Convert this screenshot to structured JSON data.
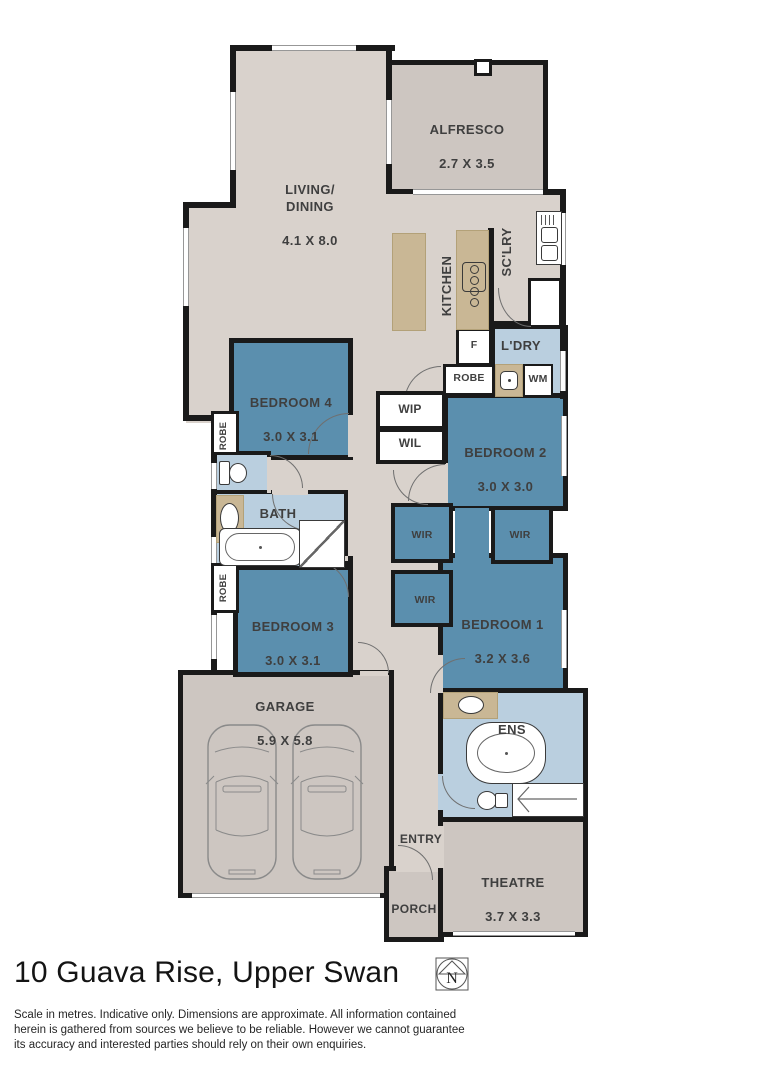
{
  "title": "10 Guava Rise, Upper Swan",
  "compass": {
    "label": "N"
  },
  "disclaimer": "Scale in metres. Indicative only. Dimensions are approximate. All information contained herein is gathered from sources we believe to be reliable. However we cannot guarantee its accuracy and interested parties should rely on their own enquiries.",
  "rooms": {
    "alfresco": {
      "name": "ALFRESCO",
      "dims": "2.7 X 3.5"
    },
    "living": {
      "name": "LIVING/\nDINING",
      "dims": "4.1 X 8.0"
    },
    "kitchen": {
      "name": "KITCHEN"
    },
    "scullery": {
      "name": "SC'LRY"
    },
    "laundry": {
      "name": "L'DRY"
    },
    "bed2": {
      "name": "BEDROOM 2",
      "dims": "3.0 X 3.0"
    },
    "bed4": {
      "name": "BEDROOM 4",
      "dims": "3.0 X 3.1"
    },
    "bed3": {
      "name": "BEDROOM 3",
      "dims": "3.0 X 3.1"
    },
    "bed1": {
      "name": "BEDROOM 1",
      "dims": "3.2 X 3.6"
    },
    "bath": {
      "name": "BATH"
    },
    "ens": {
      "name": "ENS"
    },
    "wip": {
      "name": "WIP"
    },
    "wil": {
      "name": "WIL"
    },
    "wir": {
      "name": "WIR"
    },
    "robe": {
      "name": "ROBE"
    },
    "garage": {
      "name": "GARAGE",
      "dims": "5.9 X 5.8"
    },
    "entry": {
      "name": "ENTRY"
    },
    "porch": {
      "name": "PORCH"
    },
    "theatre": {
      "name": "THEATRE",
      "dims": "3.7 X 3.3"
    }
  },
  "fixtures": {
    "fridge": "F",
    "washing_machine": "WM"
  },
  "colors": {
    "bedroom": "#5b8fae",
    "wet_area": "#bacfdf",
    "bench": "#c9b795",
    "floor_interior": "#d9d2cc",
    "floor_external": "#cdc6c1",
    "wall": "#1a1a1a"
  }
}
